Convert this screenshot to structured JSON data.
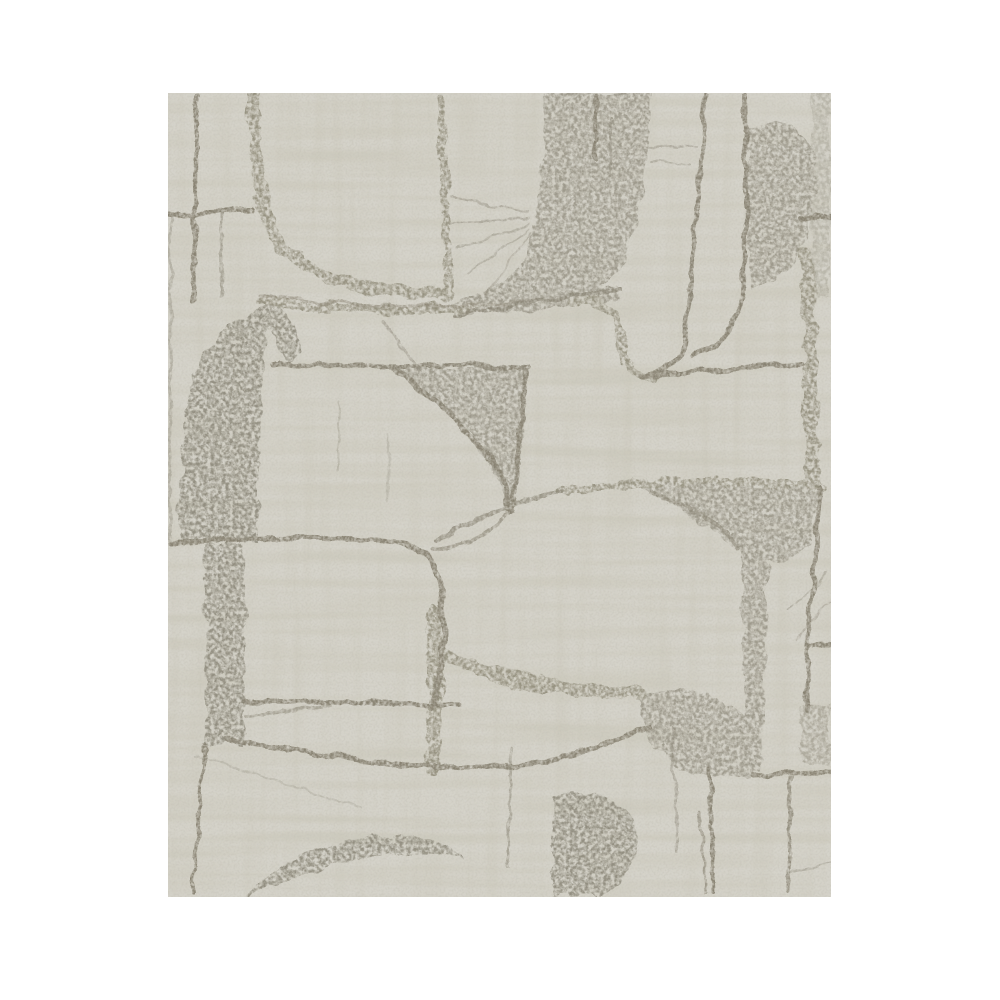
{
  "scene": {
    "type": "product-photo",
    "alt": "Abstract wallpaper swatch with textured interlocking curved shapes in grey and taupe",
    "description": "A rectangular wallpaper sample centered on a white background. The pattern is an abstract mid-century style composition of large interlocking curvilinear shapes drawn in rough taupe-grey outlines with mottled, eroded textured fills and fine scratch-like streaks on a pale warm-grey ground."
  },
  "palette": {
    "page_background": "#ffffff",
    "swatch_background": "#d6d4cb",
    "outline": "#868070",
    "mottle_stroke": "#95917f",
    "mottle_light": "#9d998b",
    "mottle_dark": "#918d7f",
    "streak": "#99937e",
    "dot": "#8c8777",
    "grain": "#8a8577"
  }
}
